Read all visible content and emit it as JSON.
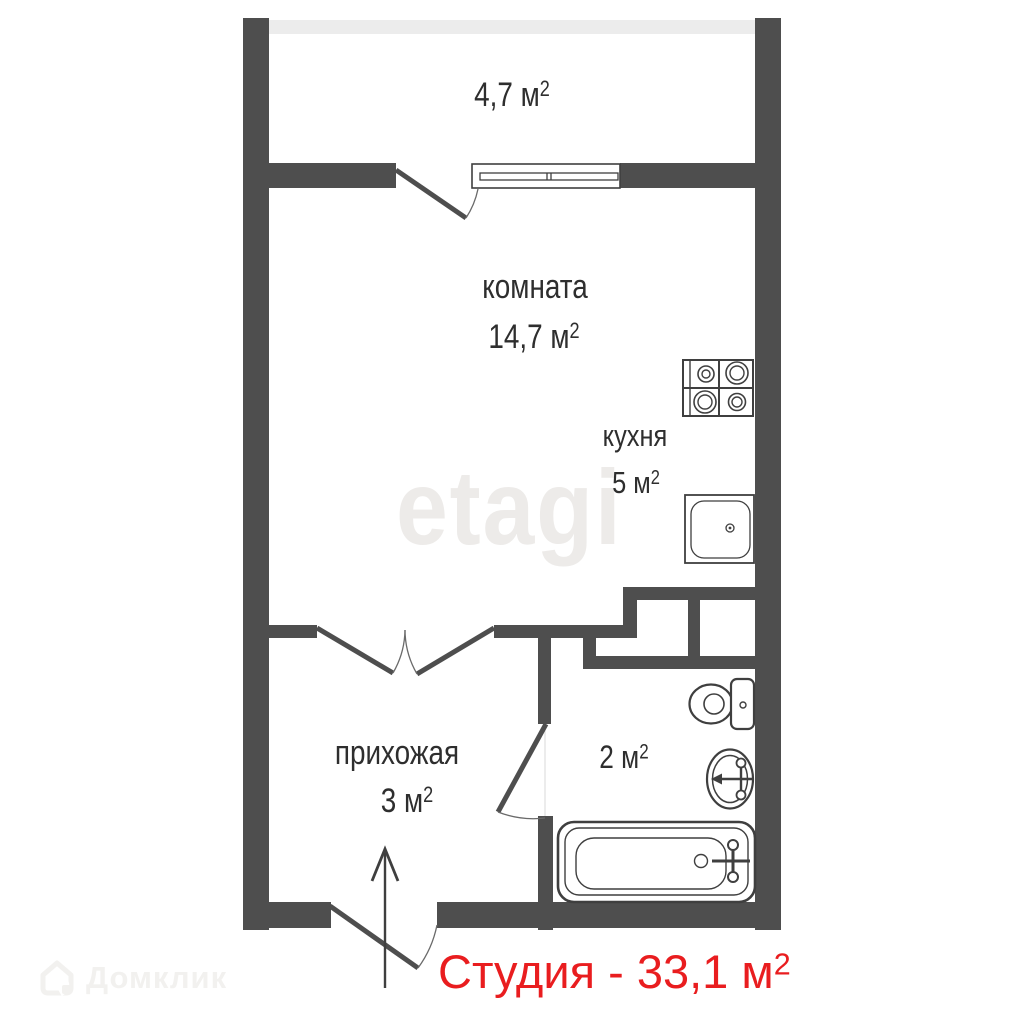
{
  "plan": {
    "title": {
      "text": "Студия - 33,1 м",
      "sup": "2"
    },
    "rooms": {
      "balcony": {
        "area": "4,7 м",
        "sup": "2"
      },
      "room": {
        "name": "комната",
        "area": "14,7 м",
        "sup": "2"
      },
      "kitchen": {
        "name": "кухня",
        "area": "5 м",
        "sup": "2"
      },
      "hallway": {
        "name": "прихожая",
        "area": "3 м",
        "sup": "2"
      },
      "bathroom": {
        "area": "2 м",
        "sup": "2"
      }
    },
    "fixtures": [
      "stove",
      "kitchen-sink",
      "toilet",
      "washbasin",
      "bathtub",
      "window",
      "balcony-door",
      "double-door",
      "bathroom-door",
      "entrance-door",
      "entrance-arrow"
    ]
  },
  "watermarks": {
    "center": "etagi",
    "bottom_left": "Домклик"
  },
  "colors": {
    "wall": "#4e4e4e",
    "balcony_wall": "#ececec",
    "label": "#2e2e2e",
    "accent_red": "#e91d1f",
    "watermark": "#edebe9",
    "watermark2": "#f2f1ef",
    "fixture": "#3f3f3f"
  }
}
